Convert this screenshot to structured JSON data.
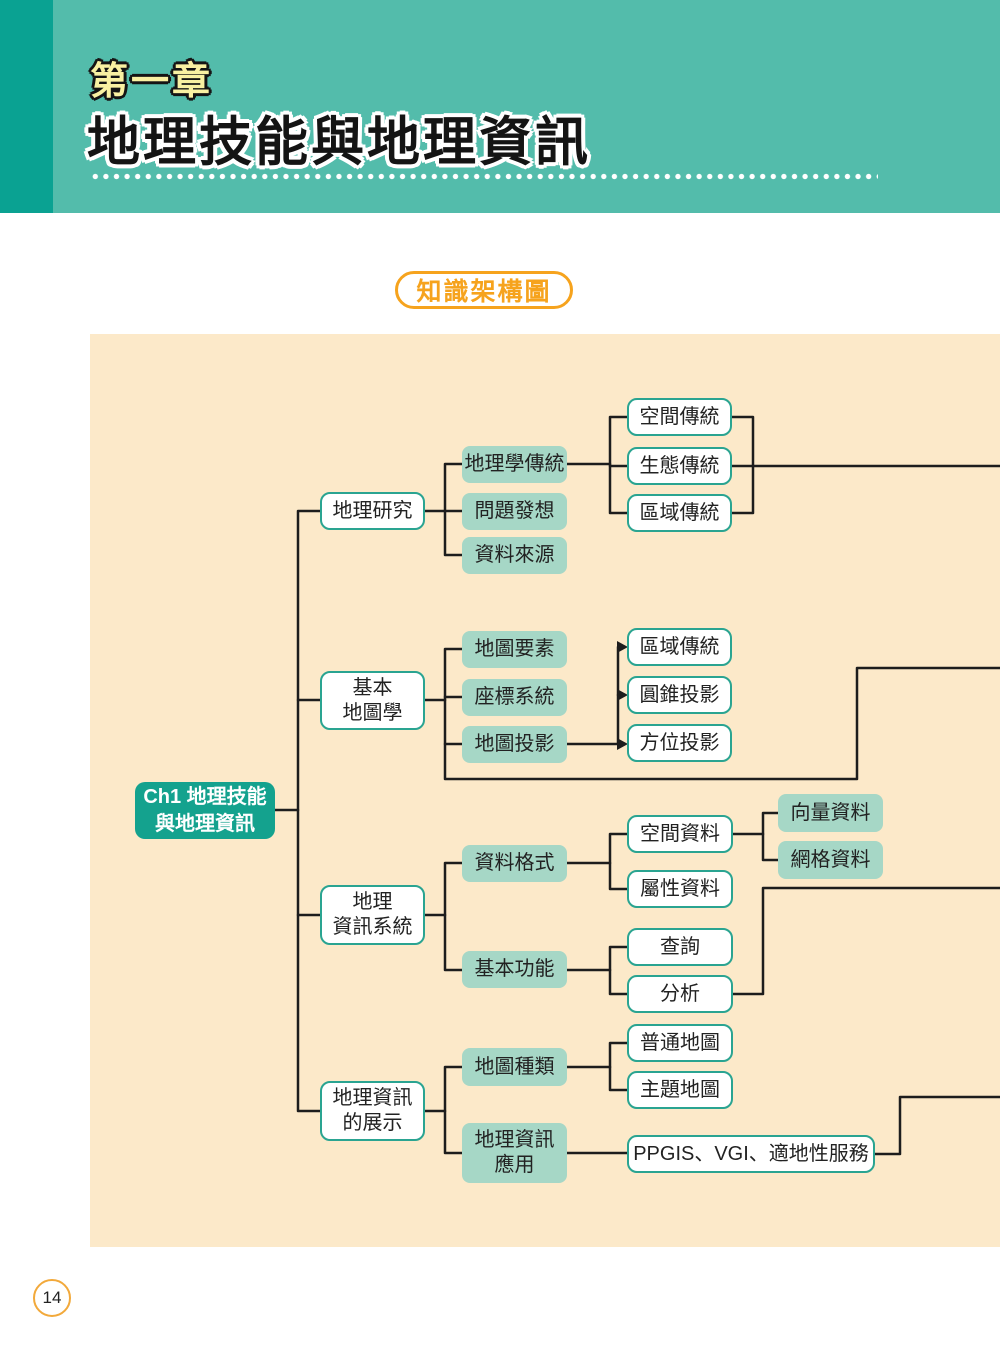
{
  "header": {
    "chapter_label": "第一章",
    "title": "地理技能與地理資訊"
  },
  "badge": {
    "label": "知識架構圖"
  },
  "page": {
    "number": "14"
  },
  "colors": {
    "header_band": "#53bcab",
    "header_strip": "#0aa292",
    "chapter_label_yellow": "#f9f1a2",
    "accent_orange": "#f6a31d",
    "panel_cream": "#fce9c9",
    "mint_box": "#a6d7c6",
    "teal_border": "#2aa491",
    "root_teal": "#14a28e",
    "connector_line": "#1d1d1d"
  },
  "diagram": {
    "root": {
      "label": "Ch1 地理技能\n與地理資訊"
    },
    "nodes": {
      "geo_research": {
        "label": "地理研究"
      },
      "basic_cartography": {
        "label": "基本\n地圖學"
      },
      "gis": {
        "label": "地理\n資訊系統"
      },
      "geo_info_display": {
        "label": "地理資訊\n的展示"
      },
      "geography_traditions": {
        "label": "地理學傳統"
      },
      "problem_ideation": {
        "label": "問題發想"
      },
      "data_sources": {
        "label": "資料來源"
      },
      "map_elements": {
        "label": "地圖要素"
      },
      "coordinate_systems": {
        "label": "座標系統"
      },
      "map_projection": {
        "label": "地圖投影"
      },
      "data_format": {
        "label": "資料格式"
      },
      "basic_functions": {
        "label": "基本功能"
      },
      "map_types": {
        "label": "地圖種類"
      },
      "geo_info_application": {
        "label": "地理資訊\n應用"
      },
      "vector_data": {
        "label": "向量資料"
      },
      "raster_data": {
        "label": "網格資料"
      },
      "spatial_tradition": {
        "label": "空間傳統"
      },
      "ecological_tradition": {
        "label": "生態傳統"
      },
      "regional_tradition": {
        "label": "區域傳統"
      },
      "regional_tradition_2": {
        "label": "區域傳統"
      },
      "conic_projection": {
        "label": "圓錐投影"
      },
      "azimuthal_projection": {
        "label": "方位投影"
      },
      "spatial_data": {
        "label": "空間資料"
      },
      "attribute_data": {
        "label": "屬性資料"
      },
      "query": {
        "label": "查詢"
      },
      "analysis": {
        "label": "分析"
      },
      "general_map": {
        "label": "普通地圖"
      },
      "thematic_map": {
        "label": "主題地圖"
      },
      "ppgis_vgi_lbs": {
        "label": "PPGIS、VGI、適地性服務"
      }
    }
  }
}
